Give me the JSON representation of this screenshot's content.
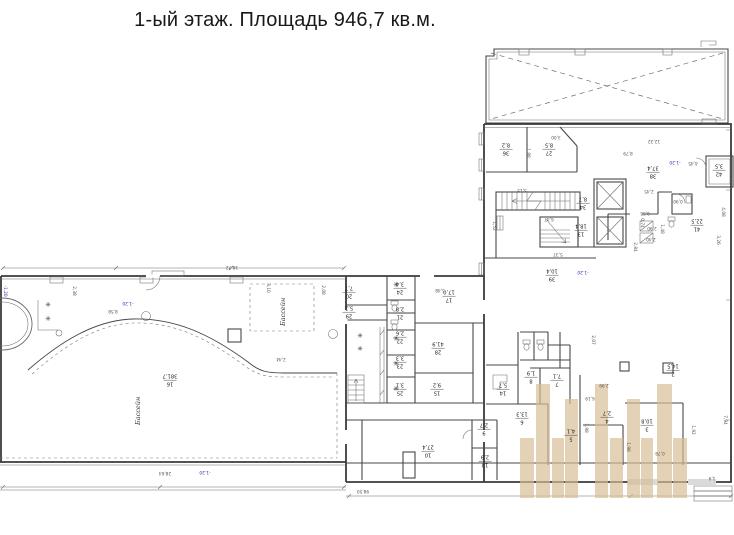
{
  "title": "1-ый этаж. Площадь 946,7 кв.м.",
  "colors": {
    "highlight": "#d8bd96",
    "wall": "#3a3a3a",
    "elevation_blue": "#2a2ab0"
  },
  "plan": {
    "pool_label_1": "Бассейн",
    "pool_label_2": "Бассейн",
    "rooms": [
      {
        "n": "36",
        "a": "8,2",
        "x": 506,
        "y": 150
      },
      {
        "n": "27",
        "a": "8,5",
        "x": 549,
        "y": 150
      },
      {
        "n": "34",
        "a": "8,7",
        "x": 583,
        "y": 204
      },
      {
        "n": "13",
        "a": "18,4",
        "x": 581,
        "y": 231
      },
      {
        "n": "38",
        "a": "37,4",
        "x": 653,
        "y": 173
      },
      {
        "n": "42",
        "a": "3,5",
        "x": 719,
        "y": 171
      },
      {
        "n": "41",
        "a": "22,5",
        "x": 697,
        "y": 226
      },
      {
        "n": "39",
        "a": "10,4",
        "x": 552,
        "y": 276
      },
      {
        "n": "17",
        "a": "17,0",
        "x": 449,
        "y": 297
      },
      {
        "n": "28",
        "a": "41,9",
        "x": 438,
        "y": 349
      },
      {
        "n": "15",
        "a": "9,2",
        "x": 437,
        "y": 390
      },
      {
        "n": "20",
        "a": "7,7",
        "x": 349,
        "y": 293
      },
      {
        "n": "29",
        "a": "5,2",
        "x": 349,
        "y": 313
      },
      {
        "n": "24",
        "a": "3,4",
        "x": 400,
        "y": 289
      },
      {
        "n": "21",
        "a": "2,8",
        "x": 400,
        "y": 314
      },
      {
        "n": "22",
        "a": "2,6",
        "x": 400,
        "y": 338
      },
      {
        "n": "23",
        "a": "3,3",
        "x": 400,
        "y": 363
      },
      {
        "n": "25",
        "a": "3,1",
        "x": 400,
        "y": 390
      },
      {
        "n": "16",
        "a": "381,7",
        "x": 170,
        "y": 381
      },
      {
        "n": "10",
        "a": "27,4",
        "x": 428,
        "y": 452
      },
      {
        "n": "9",
        "a": "2,7",
        "x": 484,
        "y": 430
      },
      {
        "n": "13",
        "a": "2,9",
        "x": 485,
        "y": 462
      },
      {
        "n": "14",
        "a": "5,7",
        "x": 503,
        "y": 390
      },
      {
        "n": "8",
        "a": "1,9",
        "x": 531,
        "y": 378
      },
      {
        "n": "7",
        "a": "7,1",
        "x": 557,
        "y": 381
      },
      {
        "n": "6",
        "a": "13,3",
        "x": 522,
        "y": 419
      },
      {
        "n": "5",
        "a": "4,1",
        "x": 571,
        "y": 436
      },
      {
        "n": "4",
        "a": "2,7",
        "x": 607,
        "y": 418
      },
      {
        "n": "3",
        "a": "10,8",
        "x": 647,
        "y": 426
      },
      {
        "n": "2",
        "a": "14,5",
        "x": 673,
        "y": 371
      }
    ],
    "dimensions": [
      {
        "t": "38,72",
        "x": 232,
        "y": 266
      },
      {
        "t": "2,38",
        "x": 73,
        "y": 291,
        "rot": 90
      },
      {
        "t": "8,58",
        "x": 113,
        "y": 310
      },
      {
        "t": "2,44",
        "x": 281,
        "y": 358
      },
      {
        "t": "3,10",
        "x": 267,
        "y": 288,
        "rot": 90
      },
      {
        "t": "2,08",
        "x": 322,
        "y": 290,
        "rot": 90
      },
      {
        "t": "28,64",
        "x": 165,
        "y": 472
      },
      {
        "t": "98,50",
        "x": 363,
        "y": 490
      },
      {
        "t": "3,00",
        "x": 556,
        "y": 136
      },
      {
        "t": "1,88",
        "x": 527,
        "y": 153,
        "rot": 90
      },
      {
        "t": "5,15",
        "x": 522,
        "y": 189
      },
      {
        "t": "5,37",
        "x": 558,
        "y": 253
      },
      {
        "t": "6,47",
        "x": 549,
        "y": 218
      },
      {
        "t": "1,52",
        "x": 493,
        "y": 226,
        "rot": 90
      },
      {
        "t": "12,32",
        "x": 654,
        "y": 140
      },
      {
        "t": "8,79",
        "x": 628,
        "y": 152
      },
      {
        "t": "4,45",
        "x": 693,
        "y": 162
      },
      {
        "t": "2,45",
        "x": 649,
        "y": 190
      },
      {
        "t": "0,90",
        "x": 678,
        "y": 200
      },
      {
        "t": "4,08",
        "x": 722,
        "y": 212,
        "rot": 90
      },
      {
        "t": "3,26",
        "x": 717,
        "y": 240,
        "rot": 90
      },
      {
        "t": "0,55",
        "x": 645,
        "y": 212
      },
      {
        "t": "2,90",
        "x": 652,
        "y": 227
      },
      {
        "t": "0,74",
        "x": 641,
        "y": 223,
        "rot": 90
      },
      {
        "t": "2,40",
        "x": 651,
        "y": 238
      },
      {
        "t": "1,48",
        "x": 661,
        "y": 229,
        "rot": 90
      },
      {
        "t": "2,84",
        "x": 634,
        "y": 247,
        "rot": 90
      },
      {
        "t": "5,48",
        "x": 440,
        "y": 289
      },
      {
        "t": "2,07",
        "x": 592,
        "y": 340,
        "rot": 90
      },
      {
        "t": "2,99",
        "x": 604,
        "y": 384
      },
      {
        "t": "6,19",
        "x": 590,
        "y": 397
      },
      {
        "t": "3,98",
        "x": 585,
        "y": 428,
        "rot": 90
      },
      {
        "t": "1,98",
        "x": 627,
        "y": 447,
        "rot": 90
      },
      {
        "t": "1,92",
        "x": 692,
        "y": 430,
        "rot": 90
      },
      {
        "t": "0,78",
        "x": 660,
        "y": 452
      },
      {
        "t": "7,94",
        "x": 724,
        "y": 420,
        "rot": 90
      },
      {
        "t": "1,9",
        "x": 712,
        "y": 477
      }
    ],
    "elevations": [
      {
        "t": "-1.20",
        "x": 675,
        "y": 161
      },
      {
        "t": "-1.20",
        "x": 583,
        "y": 271
      },
      {
        "t": "-1.20",
        "x": 205,
        "y": 471
      },
      {
        "t": "-1.20",
        "x": 128,
        "y": 302
      },
      {
        "t": "-1.20",
        "x": 4,
        "y": 291,
        "rot": 90
      }
    ],
    "showers": {
      "glyph": "✳",
      "points": [
        [
          48,
          307
        ],
        [
          48,
          321
        ],
        [
          396,
          287
        ],
        [
          396,
          341
        ],
        [
          396,
          366
        ],
        [
          396,
          391
        ],
        [
          360,
          338
        ],
        [
          360,
          351
        ]
      ]
    }
  }
}
